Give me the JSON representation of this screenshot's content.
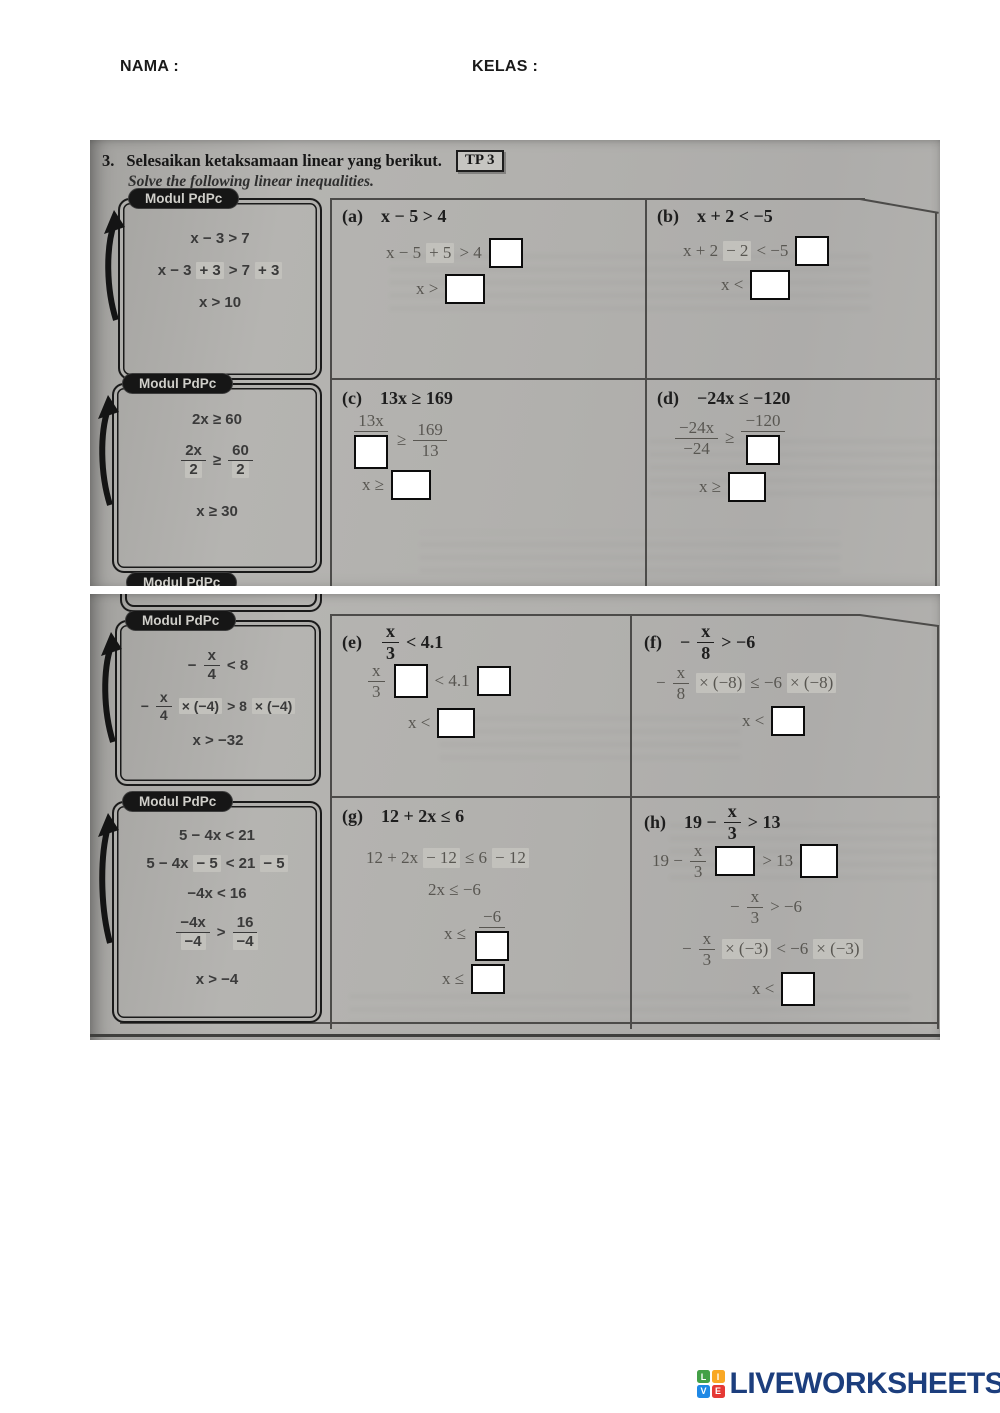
{
  "header": {
    "nama_label": "NAMA :",
    "kelas_label": "KELAS :"
  },
  "title": {
    "number": "3.",
    "ms": "Selesaikan ketaksamaan linear yang berikut.",
    "badge": "TP 3",
    "en": "Solve the following linear inequalities."
  },
  "modul_tab_label": "Modul PdPc",
  "modul1": {
    "l1": "x − 3 > 7",
    "l2a": "x − 3",
    "l2b": "+ 3",
    "l2c": "> 7",
    "l2d": "+ 3",
    "l3": "x > 10"
  },
  "modul2": {
    "l1": "2x ≥ 60",
    "f1n": "2x",
    "f1d": "2",
    "rel": "≥",
    "f2n": "60",
    "f2d": "2",
    "l3": "x ≥ 30"
  },
  "modul3": {
    "l1m": "−",
    "l1n": "x",
    "l1d": "4",
    "l1r": "< 8",
    "l2m": "−",
    "l2n": "x",
    "l2d": "4",
    "l2h1": "× (−4)",
    "l2r": "> 8",
    "l2h2": "× (−4)",
    "l3": "x > −32"
  },
  "modul4": {
    "l1": "5 − 4x < 21",
    "l2a": "5 − 4x",
    "l2b": "− 5",
    "l2c": "< 21",
    "l2d": "− 5",
    "l3": "−4x < 16",
    "f1n": "−4x",
    "f1d": "−4",
    "rel": ">",
    "f2n": "16",
    "f2d": "−4",
    "l5": "x > −4"
  },
  "cell_a": {
    "label": "(a)",
    "head": "x − 5 > 4",
    "s1a": "x − 5",
    "s1b": "+ 5",
    "s1c": "> 4",
    "s2": "x >"
  },
  "cell_b": {
    "label": "(b)",
    "head": "x + 2 < −5",
    "s1a": "x + 2",
    "s1b": "− 2",
    "s1c": "< −5",
    "s2": "x <"
  },
  "cell_c": {
    "label": "(c)",
    "head": "13x ≥ 169",
    "f1n": "13x",
    "rel": "≥",
    "f2n": "169",
    "f2d": "13",
    "s2": "x ≥"
  },
  "cell_d": {
    "label": "(d)",
    "head": "−24x ≤ −120",
    "f1n": "−24x",
    "f1d": "−24",
    "rel": "≥",
    "f2n": "−120",
    "s2": "x ≥"
  },
  "cell_e": {
    "label": "(e)",
    "hn": "x",
    "hd": "3",
    "hr": "< 4.1",
    "f1n": "x",
    "f1d": "3",
    "mid": "< 4.1",
    "s2": "x <"
  },
  "cell_f": {
    "label": "(f)",
    "hm": "−",
    "hn": "x",
    "hd": "8",
    "hr": "> −6",
    "s1m": "−",
    "s1n": "x",
    "s1d": "8",
    "s1h1": "× (−8)",
    "s1r": "≤ −6",
    "s1h2": "× (−8)",
    "s2": "x <"
  },
  "cell_g": {
    "label": "(g)",
    "head": "12 + 2x ≤ 6",
    "s1a": "12 + 2x",
    "s1b": "− 12",
    "s1c": "≤ 6",
    "s1d": "− 12",
    "s2": "2x ≤ −6",
    "s3": "x ≤",
    "s3n": "−6",
    "s4": "x ≤"
  },
  "cell_h": {
    "label": "(h)",
    "h1": "19 −",
    "hn": "x",
    "hd": "3",
    "hr": "> 13",
    "s1a": "19 −",
    "s1n": "x",
    "s1d": "3",
    "s1r": "> 13",
    "s2m": "−",
    "s2n": "x",
    "s2d": "3",
    "s2r": "> −6",
    "s3m": "−",
    "s3n": "x",
    "s3d": "3",
    "s3h1": "× (−3)",
    "s3r": "< −6",
    "s3h2": "× (−3)",
    "s4": "x <"
  },
  "footer": {
    "brand": "LIVEWORKSHEETS",
    "sq0": "L",
    "sq1": "I",
    "sq2": "V",
    "sq3": "E"
  },
  "colors": {
    "brand_navy": "#1c3e7d",
    "logo_green": "#43a047",
    "logo_orange": "#f9a825",
    "logo_blue": "#1e88e5",
    "logo_red": "#e53935",
    "scan_gray": "#b0afac",
    "answer_box_border": "#0c0c0c"
  }
}
